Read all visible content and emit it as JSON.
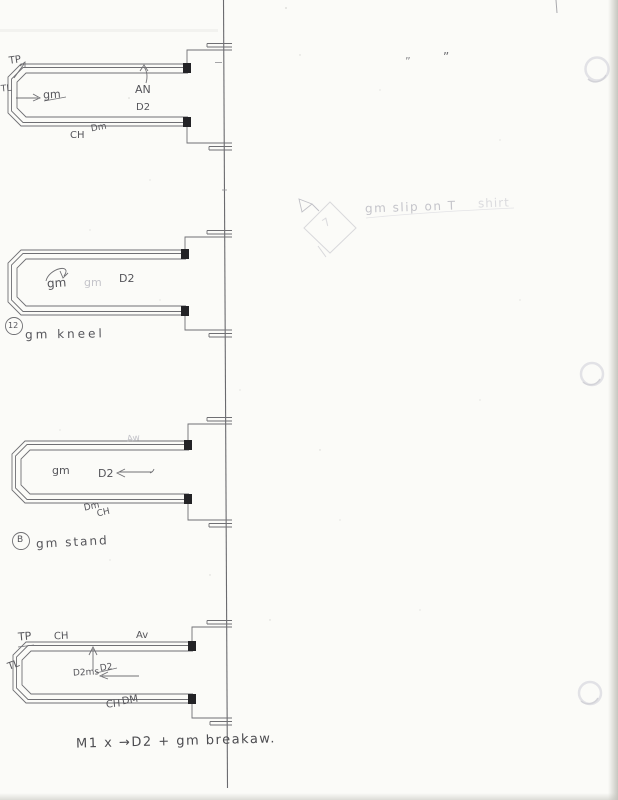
{
  "colors": {
    "paper": "#fbfbf8",
    "ink": "#55555a",
    "ink-dark": "#232326",
    "pencil": "#6f6f73",
    "faint": "#c4c4ca",
    "vfaint": "#dbdbde",
    "edge": "#c9c9c3"
  },
  "labels": {
    "l1_tp": "TP",
    "l1_tl": "TL",
    "l1_gm": "gm",
    "l1_an": "AN",
    "l1_d2": "D2",
    "l1_dm": "Dm",
    "l1_ch": "CH",
    "l2_gm": "gm",
    "l2_gm_ghost": "gm",
    "l2_d2": "D2",
    "l2_badge": "12",
    "l2_cue": "gm kneel",
    "l3_aw": "Aw",
    "l3_gm": "gm",
    "l3_d2": "D2",
    "l3_dm": "Dm",
    "l3_ch": "CH",
    "l3_badge": "B",
    "l3_cue": "gm stand",
    "l4_tp": "TP",
    "l4_ch_top": "CH",
    "l4_av": "Av",
    "l4_tl": "TL",
    "l4_d2ms": "D2ms",
    "l4_d2_struck": "D2",
    "l4_ch_bot": "CH",
    "l4_dm_bot": "DM",
    "l4_caption": "M1 x →D2 + gm breakaw.",
    "note_main": "gm slip on T",
    "note_tail": "shirt",
    "diamond_mark": "7",
    "ditto_small": "”",
    "ditto_large": "”"
  }
}
